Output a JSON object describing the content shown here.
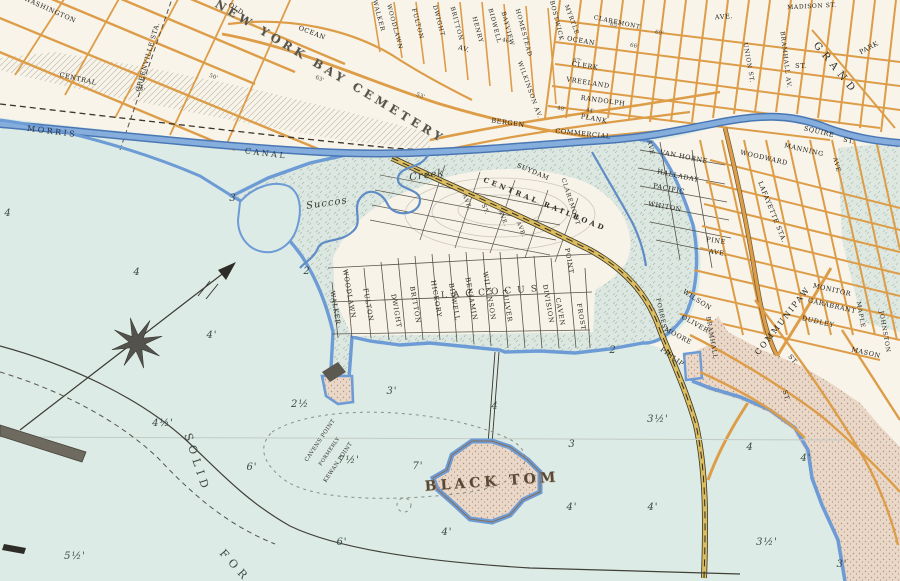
{
  "map_type": "vintage-harbor-atlas",
  "colors": {
    "water": "#dcebe5",
    "land": "#f8f4ea",
    "marsh": "#dbe7e0",
    "road_orange": "#e2a24f",
    "rail_yellow": "#dcbd5e",
    "canal_blue": "#7fa9d8",
    "shore_blue": "#6d9bd6",
    "sand_fill": "#e9d7c8",
    "ink": "#2e2c26"
  },
  "labels": [
    {
      "text": "BLACK TOM",
      "x": 492,
      "y": 482,
      "r": -4,
      "cls": "island"
    },
    {
      "text": "LACCOCUS",
      "x": 492,
      "y": 293,
      "r": -4,
      "cls": "locality"
    },
    {
      "text": "CAVENS POINT",
      "x": 321,
      "y": 441,
      "r": -56,
      "cls": "small"
    },
    {
      "text": "FORMERLY",
      "x": 330,
      "y": 452,
      "r": -56,
      "cls": "small",
      "fs": 5
    },
    {
      "text": "KEWAN POINT",
      "x": 339,
      "y": 463,
      "r": -56,
      "cls": "small"
    },
    {
      "text": "SOLID",
      "x": 197,
      "y": 463,
      "r": 72,
      "cls": "chart"
    },
    {
      "text": "FOR",
      "x": 235,
      "y": 566,
      "r": 48,
      "cls": "chart"
    },
    {
      "text": "Succos",
      "x": 327,
      "y": 204,
      "r": -8,
      "cls": "ital"
    },
    {
      "text": "Creek",
      "x": 427,
      "y": 176,
      "r": -8,
      "cls": "ital"
    },
    {
      "text": "MORRIS",
      "x": 52,
      "y": 132,
      "r": 7,
      "cls": "canal"
    },
    {
      "text": "CANAL",
      "x": 266,
      "y": 154,
      "r": 7,
      "cls": "canal"
    },
    {
      "text": "NEW YORK BAY CEMETERY",
      "x": 330,
      "y": 72,
      "r": 31,
      "cls": "cem"
    },
    {
      "text": "GREENVILLE STA.",
      "x": 148,
      "y": 57,
      "r": -74,
      "cls": "st"
    },
    {
      "text": "LAFAYETTE STA.",
      "x": 772,
      "y": 212,
      "r": 68,
      "cls": "st"
    },
    {
      "text": "CENTRAL RAILROAD",
      "x": 545,
      "y": 204,
      "r": 22,
      "cls": "rr"
    },
    {
      "text": "COMMUNIPAW",
      "x": 783,
      "y": 321,
      "r": -52,
      "cls": "st",
      "fs": 8,
      "ls": 2
    },
    {
      "text": "WASHINGTON",
      "x": 50,
      "y": 10,
      "r": 24,
      "cls": "st"
    },
    {
      "text": "CENTRAL",
      "x": 78,
      "y": 79,
      "r": 13,
      "cls": "st"
    },
    {
      "text": "OLD",
      "x": 236,
      "y": 9,
      "r": 33,
      "cls": "st"
    },
    {
      "text": "OCEAN",
      "x": 312,
      "y": 33,
      "r": 21,
      "cls": "st"
    },
    {
      "text": "AV.",
      "x": 464,
      "y": 49,
      "r": 15,
      "cls": "st"
    },
    {
      "text": "WALKER",
      "x": 378,
      "y": 16,
      "r": 75,
      "cls": "stv",
      "fs": 6
    },
    {
      "text": "WOODLAWN",
      "x": 394,
      "y": 27,
      "r": 75,
      "cls": "stv",
      "fs": 6
    },
    {
      "text": "FULTON",
      "x": 417,
      "y": 24,
      "r": 75,
      "cls": "stv",
      "fs": 6
    },
    {
      "text": "DWIGHT",
      "x": 438,
      "y": 21,
      "r": 75,
      "cls": "stv",
      "fs": 6
    },
    {
      "text": "BRITTON",
      "x": 456,
      "y": 24,
      "r": 75,
      "cls": "stv",
      "fs": 6
    },
    {
      "text": "HENRY",
      "x": 477,
      "y": 30,
      "r": 75,
      "cls": "stv",
      "fs": 6
    },
    {
      "text": "BIDWELL",
      "x": 494,
      "y": 26,
      "r": 75,
      "cls": "stv",
      "fs": 6
    },
    {
      "text": "BAYVIEW",
      "x": 507,
      "y": 29,
      "r": 75,
      "cls": "stv",
      "fs": 6
    },
    {
      "text": "HOMESTEAD",
      "x": 523,
      "y": 33,
      "r": 75,
      "cls": "stv",
      "fs": 6
    },
    {
      "text": "WILKINSON AV.",
      "x": 529,
      "y": 90,
      "r": 70,
      "cls": "stv",
      "fs": 6
    },
    {
      "text": "BERGEN",
      "x": 508,
      "y": 123,
      "r": 8,
      "cls": "st"
    },
    {
      "text": "PLANK",
      "x": 594,
      "y": 119,
      "r": 11,
      "cls": "st"
    },
    {
      "text": "COMMERCIAL",
      "x": 583,
      "y": 134,
      "r": 6,
      "cls": "st"
    },
    {
      "text": "BOSTWICK",
      "x": 556,
      "y": 21,
      "r": 76,
      "cls": "stv",
      "fs": 6
    },
    {
      "text": "MYRTLE",
      "x": 571,
      "y": 20,
      "r": 70,
      "cls": "stv",
      "fs": 6
    },
    {
      "text": "OCEAN",
      "x": 581,
      "y": 41,
      "r": 10,
      "cls": "st"
    },
    {
      "text": "CLAREMONT",
      "x": 617,
      "y": 23,
      "r": 12,
      "cls": "st",
      "fs": 6
    },
    {
      "text": "CLERK",
      "x": 585,
      "y": 66,
      "r": 9,
      "cls": "st"
    },
    {
      "text": "VREELAND",
      "x": 588,
      "y": 83,
      "r": 9,
      "cls": "st"
    },
    {
      "text": "RANDOLPH",
      "x": 603,
      "y": 101,
      "r": 8,
      "cls": "st"
    },
    {
      "text": "AVE.",
      "x": 724,
      "y": 17,
      "r": -4,
      "cls": "st"
    },
    {
      "text": "MADISON ST.",
      "x": 812,
      "y": 7,
      "r": -3,
      "cls": "st",
      "fs": 6
    },
    {
      "text": "UNION ST.",
      "x": 748,
      "y": 63,
      "r": 80,
      "cls": "stv",
      "fs": 6
    },
    {
      "text": "BRAMHALL AV.",
      "x": 785,
      "y": 60,
      "r": 83,
      "cls": "stv",
      "fs": 6
    },
    {
      "text": "GRAND",
      "x": 835,
      "y": 69,
      "r": 51,
      "cls": "st9"
    },
    {
      "text": "ST.",
      "x": 801,
      "y": 66,
      "r": 0,
      "cls": "st"
    },
    {
      "text": "PARK",
      "x": 869,
      "y": 48,
      "r": -28,
      "cls": "st"
    },
    {
      "text": "SQUIRE",
      "x": 819,
      "y": 132,
      "r": 13,
      "cls": "st"
    },
    {
      "text": "ST.",
      "x": 849,
      "y": 141,
      "r": 13,
      "cls": "st"
    },
    {
      "text": "MANNING",
      "x": 804,
      "y": 150,
      "r": 13,
      "cls": "st"
    },
    {
      "text": "WOODWARD",
      "x": 764,
      "y": 158,
      "r": 13,
      "cls": "st"
    },
    {
      "text": "VAN HORNE",
      "x": 684,
      "y": 157,
      "r": 11,
      "cls": "st"
    },
    {
      "text": "HALLADAY",
      "x": 678,
      "y": 176,
      "r": 12,
      "cls": "st"
    },
    {
      "text": "PACIFIC",
      "x": 669,
      "y": 189,
      "r": 11,
      "cls": "st"
    },
    {
      "text": "WHITON",
      "x": 665,
      "y": 207,
      "r": 10,
      "cls": "st"
    },
    {
      "text": "PINE",
      "x": 716,
      "y": 241,
      "r": 9,
      "cls": "st"
    },
    {
      "text": "AVE.",
      "x": 718,
      "y": 253,
      "r": 9,
      "cls": "st"
    },
    {
      "text": "SUYDAM",
      "x": 533,
      "y": 172,
      "r": 23,
      "cls": "st"
    },
    {
      "text": "CLAREMONT",
      "x": 570,
      "y": 202,
      "r": 72,
      "cls": "stv",
      "fs": 6
    },
    {
      "text": "AVE",
      "x": 650,
      "y": 148,
      "r": 78,
      "cls": "stv",
      "fs": 6
    },
    {
      "text": "AVE",
      "x": 836,
      "y": 165,
      "r": 75,
      "cls": "stv",
      "fs": 6
    },
    {
      "text": "WILSON",
      "x": 697,
      "y": 300,
      "r": 33,
      "cls": "st"
    },
    {
      "text": "FORREST",
      "x": 661,
      "y": 316,
      "r": 78,
      "cls": "stv",
      "fs": 6
    },
    {
      "text": "OLIVER",
      "x": 695,
      "y": 324,
      "r": 30,
      "cls": "st"
    },
    {
      "text": "MOORE",
      "x": 678,
      "y": 336,
      "r": 28,
      "cls": "st"
    },
    {
      "text": "PHILIP",
      "x": 672,
      "y": 357,
      "r": 36,
      "cls": "st"
    },
    {
      "text": "BRAMHALL",
      "x": 711,
      "y": 338,
      "r": 80,
      "cls": "stv",
      "fs": 6
    },
    {
      "text": "MONITOR",
      "x": 832,
      "y": 290,
      "r": 13,
      "cls": "st"
    },
    {
      "text": "GARABRANT",
      "x": 832,
      "y": 306,
      "r": 13,
      "cls": "st"
    },
    {
      "text": "DUDLEY",
      "x": 818,
      "y": 322,
      "r": 13,
      "cls": "st"
    },
    {
      "text": "MASON",
      "x": 866,
      "y": 353,
      "r": 13,
      "cls": "st"
    },
    {
      "text": "MAPLE",
      "x": 860,
      "y": 315,
      "r": 80,
      "cls": "stv",
      "fs": 6
    },
    {
      "text": "JOHNSTON",
      "x": 884,
      "y": 332,
      "r": 80,
      "cls": "stv",
      "fs": 6
    },
    {
      "text": "ST.",
      "x": 793,
      "y": 360,
      "r": 50,
      "cls": "st"
    },
    {
      "text": "ST.",
      "x": 786,
      "y": 396,
      "r": 75,
      "cls": "st"
    },
    {
      "text": "WALKER",
      "x": 335,
      "y": 308,
      "r": 80,
      "cls": "stv"
    },
    {
      "text": "WOODLAWN",
      "x": 349,
      "y": 294,
      "r": 80,
      "cls": "stv"
    },
    {
      "text": "FULTON",
      "x": 368,
      "y": 305,
      "r": 80,
      "cls": "stv"
    },
    {
      "text": "DWIGHT",
      "x": 396,
      "y": 311,
      "r": 80,
      "cls": "stv"
    },
    {
      "text": "BRITTON",
      "x": 415,
      "y": 305,
      "r": 80,
      "cls": "stv"
    },
    {
      "text": "HICKORY",
      "x": 436,
      "y": 299,
      "r": 80,
      "cls": "stv"
    },
    {
      "text": "BIDWELL",
      "x": 454,
      "y": 302,
      "r": 80,
      "cls": "stv"
    },
    {
      "text": "BENJAMIN",
      "x": 471,
      "y": 299,
      "r": 80,
      "cls": "stv"
    },
    {
      "text": "WILKINSON",
      "x": 489,
      "y": 296,
      "r": 80,
      "cls": "stv"
    },
    {
      "text": "CULVER",
      "x": 507,
      "y": 306,
      "r": 80,
      "cls": "stv"
    },
    {
      "text": "DIVISION",
      "x": 548,
      "y": 304,
      "r": 80,
      "cls": "stv"
    },
    {
      "text": "CAVEN",
      "x": 560,
      "y": 312,
      "r": 80,
      "cls": "stv"
    },
    {
      "text": "POINT",
      "x": 569,
      "y": 261,
      "r": 80,
      "cls": "stv"
    },
    {
      "text": "FROST",
      "x": 581,
      "y": 317,
      "r": 80,
      "cls": "stv"
    },
    {
      "text": "AVE.",
      "x": 466,
      "y": 203,
      "r": 68,
      "cls": "stv",
      "fs": 5.5
    },
    {
      "text": "ST.",
      "x": 484,
      "y": 210,
      "r": 68,
      "cls": "stv",
      "fs": 5.5
    },
    {
      "text": "AVE.",
      "x": 502,
      "y": 219,
      "r": 68,
      "cls": "stv",
      "fs": 5.5
    },
    {
      "text": "AVE.",
      "x": 520,
      "y": 230,
      "r": 68,
      "cls": "stv",
      "fs": 5.5
    },
    {
      "text": "4",
      "x": 8,
      "y": 214,
      "r": 0,
      "cls": "depth"
    },
    {
      "text": "3",
      "x": 233,
      "y": 199,
      "r": 0,
      "cls": "depth"
    },
    {
      "text": "4",
      "x": 137,
      "y": 273,
      "r": 0,
      "cls": "depth"
    },
    {
      "text": "2",
      "x": 307,
      "y": 272,
      "r": 0,
      "cls": "depth"
    },
    {
      "text": "4'",
      "x": 212,
      "y": 336,
      "r": 0,
      "cls": "depth"
    },
    {
      "text": "2",
      "x": 613,
      "y": 351,
      "r": 0,
      "cls": "depth"
    },
    {
      "text": "2½",
      "x": 300,
      "y": 405,
      "r": 0,
      "cls": "depth"
    },
    {
      "text": "3'",
      "x": 392,
      "y": 392,
      "r": 0,
      "cls": "depth"
    },
    {
      "text": "4",
      "x": 495,
      "y": 407,
      "r": 0,
      "cls": "depth"
    },
    {
      "text": "7½'",
      "x": 349,
      "y": 461,
      "r": 0,
      "cls": "depth"
    },
    {
      "text": "7'",
      "x": 418,
      "y": 467,
      "r": 0,
      "cls": "depth"
    },
    {
      "text": "4½'",
      "x": 163,
      "y": 424,
      "r": 0,
      "cls": "depth"
    },
    {
      "text": "6'",
      "x": 252,
      "y": 468,
      "r": 0,
      "cls": "depth"
    },
    {
      "text": "6'",
      "x": 342,
      "y": 543,
      "r": 0,
      "cls": "depth"
    },
    {
      "text": "4'",
      "x": 447,
      "y": 533,
      "r": 0,
      "cls": "depth"
    },
    {
      "text": "5½'",
      "x": 75,
      "y": 557,
      "r": 0,
      "cls": "depth"
    },
    {
      "text": "3½'",
      "x": 658,
      "y": 420,
      "r": 0,
      "cls": "depth"
    },
    {
      "text": "3",
      "x": 572,
      "y": 445,
      "r": 0,
      "cls": "depth"
    },
    {
      "text": "4",
      "x": 750,
      "y": 448,
      "r": 0,
      "cls": "depth"
    },
    {
      "text": "4'",
      "x": 806,
      "y": 459,
      "r": 0,
      "cls": "depth"
    },
    {
      "text": "4'",
      "x": 572,
      "y": 508,
      "r": 0,
      "cls": "depth"
    },
    {
      "text": "4'",
      "x": 653,
      "y": 508,
      "r": 0,
      "cls": "depth"
    },
    {
      "text": "3½'",
      "x": 767,
      "y": 543,
      "r": 0,
      "cls": "depth"
    },
    {
      "text": "3'",
      "x": 842,
      "y": 565,
      "r": 0,
      "cls": "depth"
    },
    {
      "text": "50'",
      "x": 213,
      "y": 78,
      "r": 20,
      "cls": "tiny"
    },
    {
      "text": "45'",
      "x": 140,
      "y": 90,
      "r": 25,
      "cls": "tiny"
    },
    {
      "text": "63'",
      "x": 319,
      "y": 80,
      "r": 25,
      "cls": "tiny"
    },
    {
      "text": "53'",
      "x": 420,
      "y": 97,
      "r": 20,
      "cls": "tiny"
    },
    {
      "text": "46'",
      "x": 506,
      "y": 42,
      "r": 15,
      "cls": "tiny"
    },
    {
      "text": "48'",
      "x": 561,
      "y": 110,
      "r": 10,
      "cls": "tiny"
    },
    {
      "text": "44'",
      "x": 590,
      "y": 112,
      "r": 10,
      "cls": "tiny"
    },
    {
      "text": "65'",
      "x": 614,
      "y": 26,
      "r": 12,
      "cls": "tiny"
    },
    {
      "text": "66'",
      "x": 634,
      "y": 47,
      "r": 12,
      "cls": "tiny"
    },
    {
      "text": "67'",
      "x": 577,
      "y": 62,
      "r": 10,
      "cls": "tiny"
    },
    {
      "text": "69'",
      "x": 659,
      "y": 34,
      "r": 12,
      "cls": "tiny"
    }
  ]
}
